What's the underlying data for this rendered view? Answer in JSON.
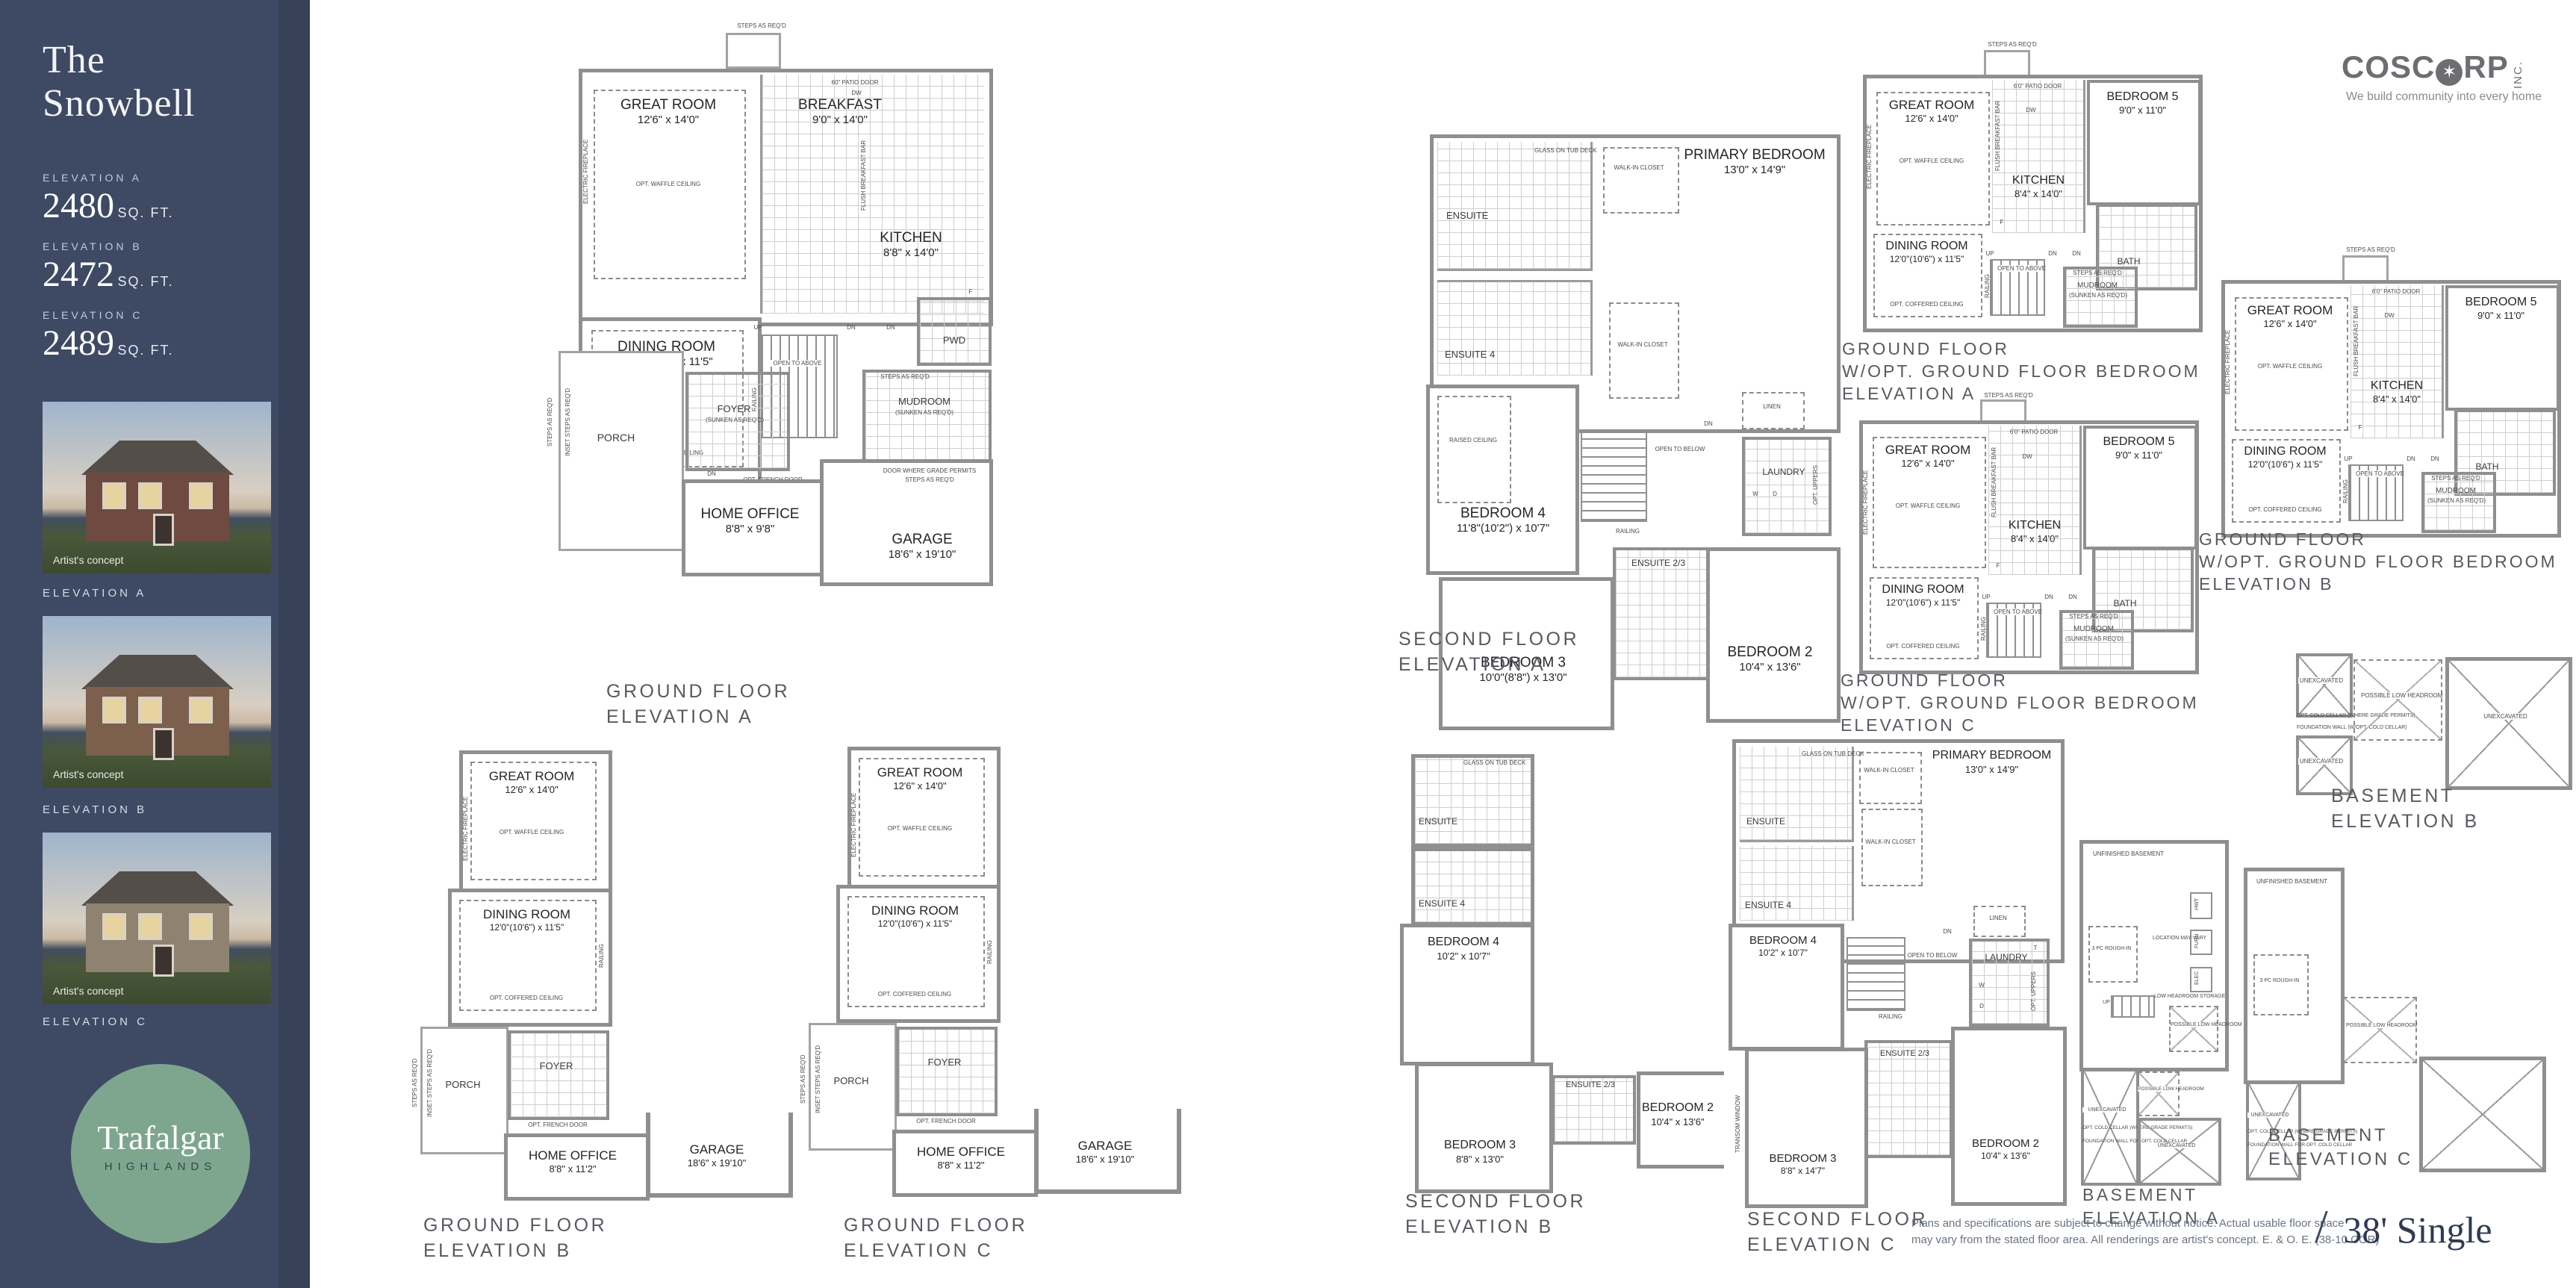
{
  "sidebar": {
    "title_line1": "The",
    "title_line2": "Snowbell",
    "elevations": [
      {
        "label": "ELEVATION A",
        "sqft": "2480",
        "unit": "SQ. FT."
      },
      {
        "label": "ELEVATION B",
        "sqft": "2472",
        "unit": "SQ. FT."
      },
      {
        "label": "ELEVATION C",
        "sqft": "2489",
        "unit": "SQ. FT."
      }
    ],
    "renderings": [
      {
        "caption": "Artist's concept",
        "label": "ELEVATION A"
      },
      {
        "caption": "Artist's concept",
        "label": "ELEVATION B"
      },
      {
        "caption": "Artist's concept",
        "label": "ELEVATION C"
      }
    ],
    "logo": {
      "line1": "Trafalgar",
      "line2": "HIGHLANDS"
    }
  },
  "header": {
    "coscorp_name_left": "COSC",
    "coscorp_leaf": "✶",
    "coscorp_name_right": "RP",
    "coscorp_inc": "INC.",
    "coscorp_tagline": "We build community into every home"
  },
  "footer": {
    "disclaimer_line1": "Plans and specifications are subject to change without notice. Actual usable floor space",
    "disclaimer_line2": "may vary from the stated floor area. All renderings are artist's concept. E. & O. E. (38-10 COR)",
    "slash": "/",
    "product": "38' Single"
  },
  "plans": {
    "gf_a": {
      "caption": [
        "GROUND FLOOR",
        "ELEVATION A"
      ],
      "labels": {
        "steps": "STEPS AS REQ'D",
        "patio_door": "60\" PATIO DOOR",
        "great_room": "GREAT ROOM",
        "great_room_dims": "12'6\" x 14'0\"",
        "waffle": "OPT. WAFFLE CEILING",
        "fireplace": "ELECTRIC FIREPLACE",
        "breakfast": "BREAKFAST",
        "breakfast_dims": "9'0\" x 14'0\"",
        "kitchen": "KITCHEN",
        "kitchen_dims": "8'8\" x 14'0\"",
        "flush_bar": "FLUSH BREAKFAST BAR",
        "dw": "DW",
        "fridge": "F",
        "dining": "DINING ROOM",
        "dining_dims": "12'0\"(10'6\") x 11'5\"",
        "coffered": "OPT. COFFERED CEILING",
        "pwd": "PWD",
        "mudroom": "MUDROOM",
        "sunken": "(SUNKEN AS REQ'D)",
        "open_above": "OPEN TO ABOVE",
        "railing": "RAILING",
        "up": "UP",
        "dn": "DN",
        "foyer": "FOYER",
        "french_door": "OPT. FRENCH DOOR",
        "porch": "PORCH",
        "inset_steps": "INSET STEPS AS REQ'D",
        "office": "HOME OFFICE",
        "office_dims": "8'8\" x 9'8\"",
        "garage": "GARAGE",
        "garage_dims": "18'6\" x 19'10\"",
        "door_grade": "DOOR WHERE GRADE PERMITS",
        "steps_grade": "STEPS AS REQ'D"
      }
    },
    "gf_b": {
      "caption": [
        "GROUND FLOOR",
        "ELEVATION B"
      ],
      "labels": {
        "great_room": "GREAT ROOM",
        "great_room_dims": "12'6\" x 14'0\"",
        "waffle": "OPT. WAFFLE CEILING",
        "fireplace": "ELECTRIC FIREPLACE",
        "dining": "DINING ROOM",
        "dining_dims": "12'0\"(10'6\") x 11'5\"",
        "coffered": "OPT. COFFERED CEILING",
        "railing": "RAILING",
        "porch": "PORCH",
        "steps": "STEPS AS REQ'D",
        "inset_steps": "INSET STEPS AS REQ'D",
        "foyer": "FOYER",
        "french_door": "OPT. FRENCH DOOR",
        "office": "HOME OFFICE",
        "office_dims": "8'8\" x 11'2\"",
        "garage": "GARAGE",
        "garage_dims": "18'6\" x 19'10\""
      }
    },
    "gf_c": {
      "caption": [
        "GROUND FLOOR",
        "ELEVATION C"
      ],
      "labels": {
        "great_room": "GREAT ROOM",
        "great_room_dims": "12'6\" x 14'0\"",
        "waffle": "OPT. WAFFLE CEILING",
        "fireplace": "ELECTRIC FIREPLACE",
        "dining": "DINING ROOM",
        "dining_dims": "12'0\"(10'6\") x 11'5\"",
        "coffered": "OPT. COFFERED CEILING",
        "railing": "RAILING",
        "porch": "PORCH",
        "steps": "STEPS AS REQ'D",
        "inset_steps": "INSET STEPS AS REQ'D",
        "foyer": "FOYER",
        "french_door": "OPT. FRENCH DOOR",
        "office": "HOME OFFICE",
        "office_dims": "8'8\" x 11'2\"",
        "garage": "GARAGE",
        "garage_dims": "18'6\" x 19'10\""
      }
    },
    "sf_a": {
      "caption": [
        "SECOND FLOOR",
        "ELEVATION A"
      ],
      "labels": {
        "primary": "PRIMARY BEDROOM",
        "primary_dims": "13'0\" x 14'9\"",
        "ensuite": "ENSUITE",
        "glass_tub": "GLASS ON TUB DECK",
        "wic": "WALK-IN CLOSET",
        "ensuite4": "ENSUITE 4",
        "bedroom4": "BEDROOM 4",
        "bedroom4_dims": "11'8\"(10'2\") x 10'7\"",
        "raised": "RAISED CEILING",
        "open_below": "OPEN TO BELOW",
        "railing": "RAILING",
        "dn": "DN",
        "linen": "LINEN",
        "laundry": "LAUNDRY",
        "washer": "W",
        "dryer": "D",
        "opt_uppers": "OPT. UPPERS",
        "ensuite23": "ENSUITE 2/3",
        "bedroom3": "BEDROOM 3",
        "bedroom3_dims": "10'0\"(8'8\") x 13'0\"",
        "bedroom2": "BEDROOM 2",
        "bedroom2_dims": "10'4\" x 13'6\""
      }
    },
    "sf_b": {
      "caption": [
        "SECOND FLOOR",
        "ELEVATION B"
      ],
      "labels": {
        "ensuite": "ENSUITE",
        "glass_tub": "GLASS ON TUB DECK",
        "ensuite4": "ENSUITE 4",
        "bedroom4": "BEDROOM 4",
        "bedroom4_dims": "10'2\" x 10'7\"",
        "bedroom3": "BEDROOM 3",
        "bedroom3_dims": "8'8\" x 13'0\"",
        "ensuite23": "ENSUITE 2/3",
        "bedroom2": "BEDROOM 2",
        "bedroom2_dims": "10'4\" x 13'6\""
      }
    },
    "sf_c": {
      "caption": [
        "SECOND FLOOR",
        "ELEVATION C"
      ],
      "labels": {
        "primary": "PRIMARY BEDROOM",
        "primary_dims": "13'0\" x 14'9\"",
        "ensuite": "ENSUITE",
        "glass_tub": "GLASS ON TUB DECK",
        "wic": "WALK-IN CLOSET",
        "ensuite4": "ENSUITE 4",
        "bedroom4": "BEDROOM 4",
        "bedroom4_dims": "10'2\" x 10'7\"",
        "open_below": "OPEN TO BELOW",
        "railing": "RAILING",
        "dn": "DN",
        "linen": "LINEN",
        "laundry": "LAUNDRY",
        "tub_t": "T",
        "washer": "W",
        "dryer": "D",
        "opt_uppers": "OPT. UPPERS",
        "ensuite23": "ENSUITE 2/3",
        "bedroom3": "BEDROOM 3",
        "bedroom3_dims": "8'8\" x 14'7\"",
        "transom": "TRANSOM WINDOW",
        "bedroom2": "BEDROOM 2",
        "bedroom2_dims": "10'4\" x 13'6\""
      }
    },
    "gfb_a": {
      "caption": [
        "GROUND FLOOR",
        "W/OPT. GROUND FLOOR BEDROOM",
        "ELEVATION A"
      ],
      "labels": {
        "steps": "STEPS AS REQ'D",
        "patio_door": "6'0\" PATIO DOOR",
        "great_room": "GREAT ROOM",
        "great_room_dims": "12'6\" x 14'0\"",
        "waffle": "OPT. WAFFLE CEILING",
        "fireplace": "ELECTRIC FIREPLACE",
        "kitchen": "KITCHEN",
        "kitchen_dims": "8'4\" x 14'0\"",
        "flush_bar": "FLUSH BREAKFAST BAR",
        "dw": "DW",
        "fridge": "F",
        "bedroom5": "BEDROOM 5",
        "bedroom5_dims": "9'0\" x 11'0\"",
        "bath": "BATH",
        "dining": "DINING ROOM",
        "dining_dims": "12'0\"(10'6\") x 11'5\"",
        "coffered": "OPT. COFFERED CEILING",
        "open_above": "OPEN TO ABOVE",
        "railing": "RAILING",
        "up": "UP",
        "dn": "DN",
        "mudroom": "MUDROOM",
        "sunken": "(SUNKEN AS REQ'D)",
        "steps_req": "STEPS AS REQ'D"
      }
    },
    "gfb_b": {
      "caption": [
        "GROUND FLOOR",
        "W/OPT. GROUND FLOOR BEDROOM",
        "ELEVATION B"
      ],
      "labels": {
        "steps": "STEPS AS REQ'D",
        "patio_door": "6'0\" PATIO DOOR",
        "great_room": "GREAT ROOM",
        "great_room_dims": "12'6\" x 14'0\"",
        "waffle": "OPT. WAFFLE CEILING",
        "fireplace": "ELECTRIC FIREPLACE",
        "kitchen": "KITCHEN",
        "kitchen_dims": "8'4\" x 14'0\"",
        "flush_bar": "FLUSH BREAKFAST BAR",
        "dw": "DW",
        "fridge": "F",
        "bedroom5": "BEDROOM 5",
        "bedroom5_dims": "9'0\" x 11'0\"",
        "bath": "BATH",
        "dining": "DINING ROOM",
        "dining_dims": "12'0\"(10'6\") x 11'5\"",
        "coffered": "OPT. COFFERED CEILING",
        "open_above": "OPEN TO ABOVE",
        "railing": "RAILING",
        "up": "UP",
        "dn": "DN",
        "mudroom": "MUDROOM",
        "sunken": "(SUNKEN AS REQ'D)",
        "steps_req": "STEPS AS REQ'D"
      }
    },
    "gfb_c": {
      "caption": [
        "GROUND FLOOR",
        "W/OPT. GROUND FLOOR BEDROOM",
        "ELEVATION C"
      ],
      "labels": {
        "steps": "STEPS AS REQ'D",
        "patio_door": "6'0\" PATIO DOOR",
        "great_room": "GREAT ROOM",
        "great_room_dims": "12'6\" x 14'0\"",
        "waffle": "OPT. WAFFLE CEILING",
        "fireplace": "ELECTRIC FIREPLACE",
        "kitchen": "KITCHEN",
        "kitchen_dims": "8'4\" x 14'0\"",
        "flush_bar": "FLUSH BREAKFAST BAR",
        "dw": "DW",
        "fridge": "F",
        "bedroom5": "BEDROOM 5",
        "bedroom5_dims": "9'0\" x 11'0\"",
        "bath": "BATH",
        "dining": "DINING ROOM",
        "dining_dims": "12'0\"(10'6\") x 11'5\"",
        "coffered": "OPT. COFFERED CEILING",
        "open_above": "OPEN TO ABOVE",
        "railing": "RAILING",
        "up": "UP",
        "dn": "DN",
        "mudroom": "MUDROOM",
        "sunken": "(SUNKEN AS REQ'D)",
        "steps_req": "STEPS AS REQ'D"
      }
    },
    "bsmt_a": {
      "caption": [
        "BASEMENT",
        "ELEVATION A"
      ],
      "labels": {
        "unfinished": "UNFINISHED BASEMENT",
        "rough_in": "3 PC ROUGH-IN",
        "up": "UP",
        "low_storage": "LOW HEADROOM STORAGE",
        "possible": "POSSIBLE LOW HEADROOM",
        "hwt": "HWT",
        "furn": "FURN",
        "elec": "ELEC",
        "loc_vary": "LOCATION MAY VARY",
        "unexcavated": "UNEXCAVATED",
        "cold_cellar": "OPT. COLD CELLAR (WHERE GRADE PERMITS)",
        "fdn_wall": "FOUNDATION WALL FOR OPT. COLD CELLAR"
      }
    },
    "bsmt_b": {
      "caption": [
        "BASEMENT",
        "ELEVATION B"
      ],
      "labels": {
        "unexcavated": "UNEXCAVATED",
        "possible": "POSSIBLE LOW HEADROOM",
        "cold_cellar": "OPT. COLD CELLAR (WHERE GRADE PERMITS)",
        "fdn_wall": "FOUNDATION WALL (W/OPT. COLD CELLAR)"
      }
    },
    "bsmt_c": {
      "caption": [
        "BASEMENT",
        "ELEVATION C"
      ],
      "labels": {
        "unfinished": "UNFINISHED BASEMENT",
        "rough_in": "3 PC ROUGH-IN",
        "possible": "POSSIBLE LOW HEADROOM",
        "unexcavated": "UNEXCAVATED",
        "cold_cellar": "OPT. COLD CELLAR (WHERE GRADE PERMITS)",
        "fdn_wall": "FOUNDATION WALL FOR OPT. COLD CELLAR"
      }
    }
  }
}
